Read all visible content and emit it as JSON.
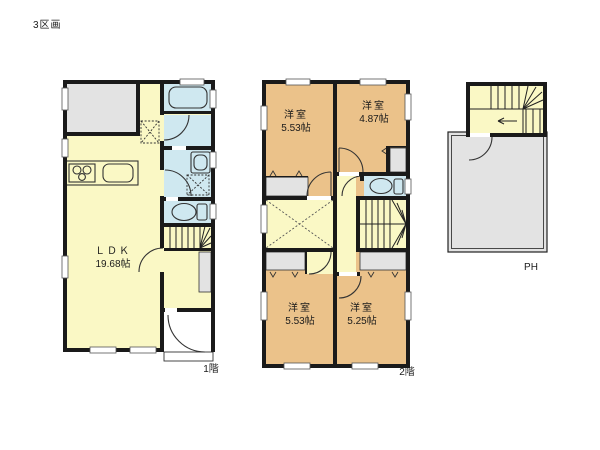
{
  "page": {
    "plot_label": "3区画"
  },
  "floor1": {
    "floor_label": "1階",
    "room": {
      "name": "ＬＤＫ",
      "size": "19.68帖"
    }
  },
  "floor2": {
    "floor_label": "2階",
    "rooms": [
      {
        "name": "洋室",
        "size": "5.53帖"
      },
      {
        "name": "洋室",
        "size": "4.87帖"
      },
      {
        "name": "洋室",
        "size": "5.53帖"
      },
      {
        "name": "洋室",
        "size": "5.25帖"
      }
    ]
  },
  "penthouse": {
    "floor_label": "PH"
  },
  "colors": {
    "room_orange": "#EBC28A",
    "ldk_yellow": "#FAF8C5",
    "wet_blue": "#CFE8F0",
    "gray_area": "#E3E3E3",
    "wall_black": "#1A1A1A"
  }
}
